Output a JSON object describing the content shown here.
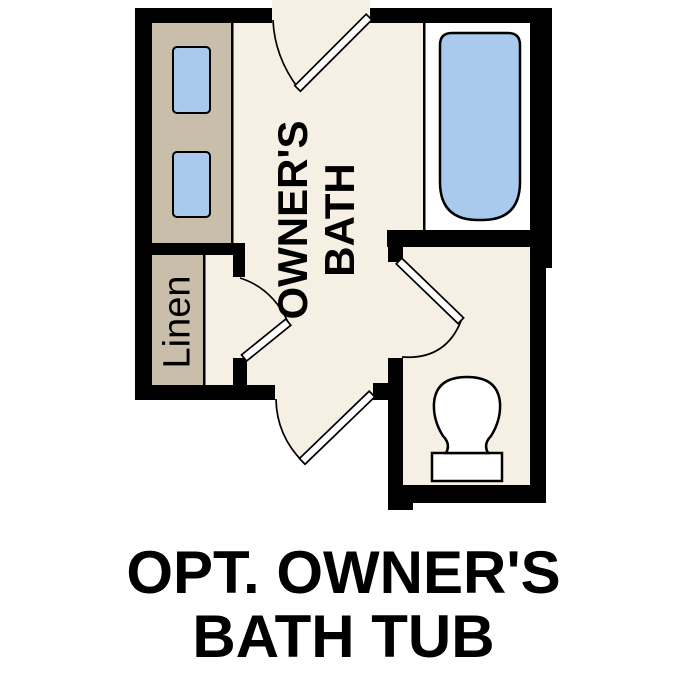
{
  "plan": {
    "room_label": {
      "line1": "OWNER'S",
      "line2": "BATH"
    },
    "linen_label": "Linen",
    "colors": {
      "wall": "#000000",
      "floor": "#F6EFE4",
      "cabinet": "#C9BEA9",
      "fixture_blue": "#A9CAEC",
      "tub_alcove": "#FFFFFF",
      "outline": "#000000"
    },
    "fixtures": [
      {
        "name": "vanity-counter"
      },
      {
        "name": "vanity-sink-1"
      },
      {
        "name": "vanity-sink-2"
      },
      {
        "name": "bathtub"
      },
      {
        "name": "toilet"
      },
      {
        "name": "linen-closet"
      },
      {
        "name": "entry-door-swing"
      },
      {
        "name": "linen-door-swing"
      },
      {
        "name": "water-closet-door-swing"
      },
      {
        "name": "bottom-door-swing"
      }
    ]
  },
  "caption": {
    "line1": "OPT. OWNER'S",
    "line2": "BATH TUB"
  }
}
